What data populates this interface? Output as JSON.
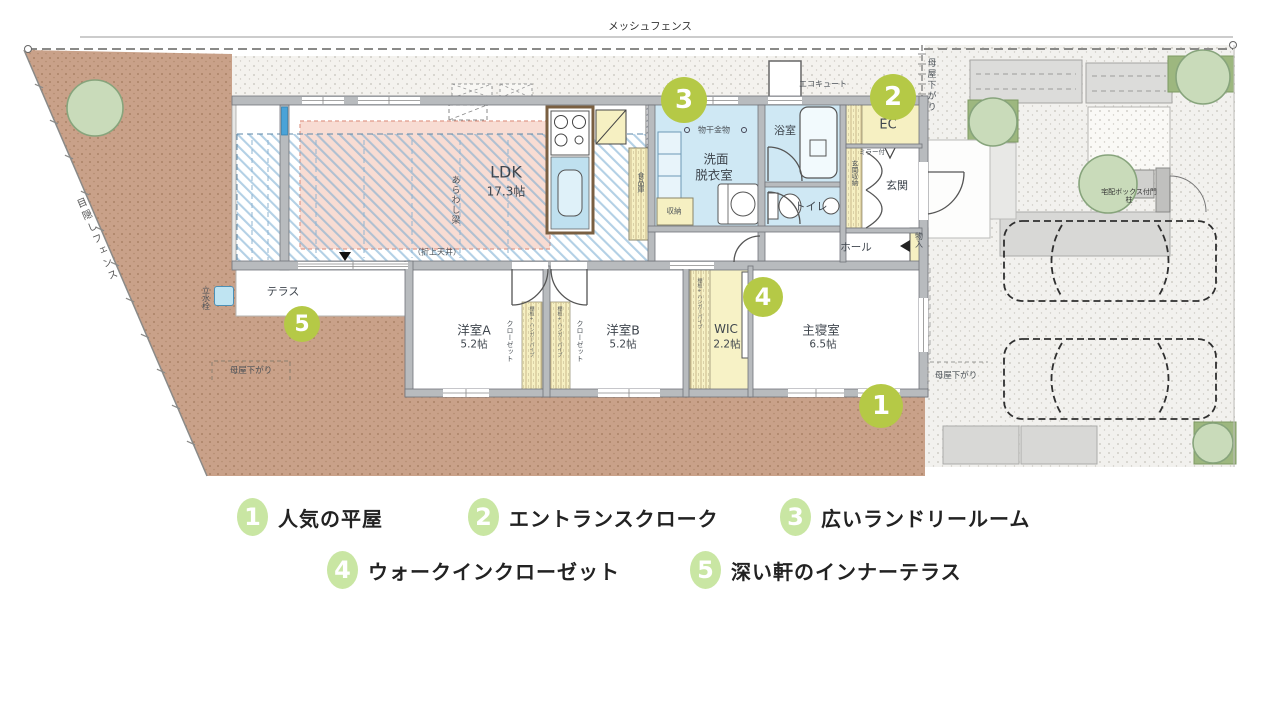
{
  "site": {
    "fence_top_label": "メッシュフェンス",
    "fence_left_label": "目隠しフェンス",
    "moya_sagari_top_right": "母屋下がり",
    "moya_sagari_bottom_left": "母屋下がり",
    "moya_sagari_bottom_right": "母屋下がり",
    "tap_label": "立水栓",
    "gate_label": "宅配ボックス付門柱",
    "ecocute_label": "エコキュート"
  },
  "plan": {
    "ldk": {
      "name": "LDK",
      "size": "17.3帖",
      "beam_note": "あらわし梁",
      "ceiling_note": "（折上天井）"
    },
    "terrace": "テラス",
    "washroom": {
      "line1": "洗面",
      "line2": "脱衣室",
      "hanger_note": "物干金物",
      "storage": "収納"
    },
    "bath": "浴室",
    "toilet": "トイレ",
    "pantry": "食品庫",
    "ec": "EC",
    "entrance": {
      "name": "玄関",
      "storage": "玄関収納",
      "mirror_note": "ミラー付"
    },
    "hall": "ホール",
    "closet_small": "物入",
    "room_a": {
      "name": "洋室A",
      "size": "5.2帖",
      "closet": "クローゼット",
      "shelf_note": "棚板+ハンガーパイプ"
    },
    "room_b": {
      "name": "洋室B",
      "size": "5.2帖",
      "closet": "クローゼット",
      "shelf_note": "棚板+ハンガーパイプ"
    },
    "wic": {
      "name": "WIC",
      "size": "2.2帖",
      "shelf_note": "棚板+ハンガーパイプ"
    },
    "master": {
      "name": "主寝室",
      "size": "6.5帖"
    }
  },
  "markers": {
    "m1": "1",
    "m2": "2",
    "m3": "3",
    "m4": "4",
    "m5": "5"
  },
  "legend": {
    "items": [
      {
        "num": "1",
        "label": "人気の平屋"
      },
      {
        "num": "2",
        "label": "エントランスクローク"
      },
      {
        "num": "3",
        "label": "広いランドリールーム"
      },
      {
        "num": "4",
        "label": "ウォークインクローゼット"
      },
      {
        "num": "5",
        "label": "深い軒のインナーテラス"
      }
    ]
  },
  "colors": {
    "marker_green": "#b5c946",
    "legend_green": "#c9e6a3",
    "dirt": "#c9a189",
    "room_blue": "#cfe8f4",
    "room_yellow": "#f6f0c2",
    "ceiling_pink": "#f8dcd3",
    "hatch_blue": "#74a9d0"
  }
}
